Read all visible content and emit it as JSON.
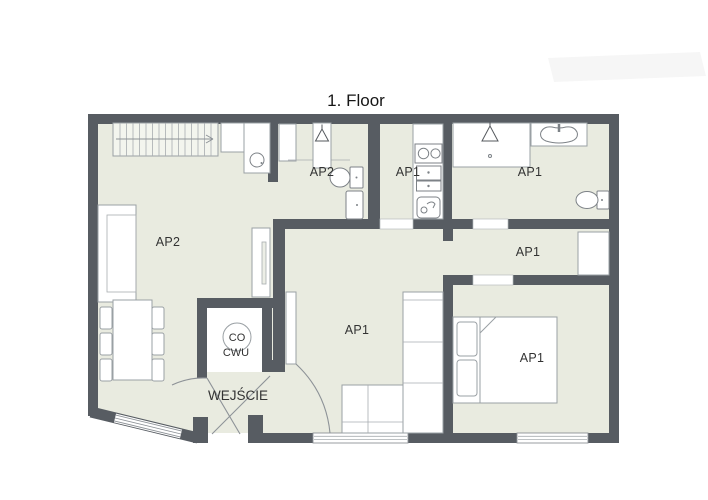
{
  "title": "1. Floor",
  "rooms": {
    "ap2_living": {
      "label": "AP2"
    },
    "ap2_bathroom": {
      "label": "AP2"
    },
    "ap1_kitchen": {
      "label": "AP1"
    },
    "ap1_bathroom": {
      "label": "AP1"
    },
    "ap1_hall": {
      "label": "AP1"
    },
    "ap1_living": {
      "label": "AP1"
    },
    "ap1_bedroom": {
      "label": "AP1"
    },
    "entrance": {
      "label": "WEJŚCIE"
    },
    "boiler": {
      "label_top": "CO",
      "label_bottom": "CWU"
    }
  },
  "icons": [
    "stairs-icon",
    "stair-direction-arrow-icon",
    "wardrobe-hanger-icon",
    "toilet-icon",
    "washbasin-icon",
    "kitchen-sink-icon",
    "stove-icon",
    "oven-icon",
    "shower-icon",
    "sofa-icon",
    "corner-sofa-icon",
    "dining-table-icon",
    "chair-icon",
    "tv-cabinet-icon",
    "double-bed-icon",
    "boiler-icon",
    "door-swing-icon",
    "window-icon"
  ],
  "colors": {
    "wall": "#575c62",
    "floor": "#e9ebe0",
    "furniture_outline": "#9aa0a4",
    "text": "#333333"
  }
}
